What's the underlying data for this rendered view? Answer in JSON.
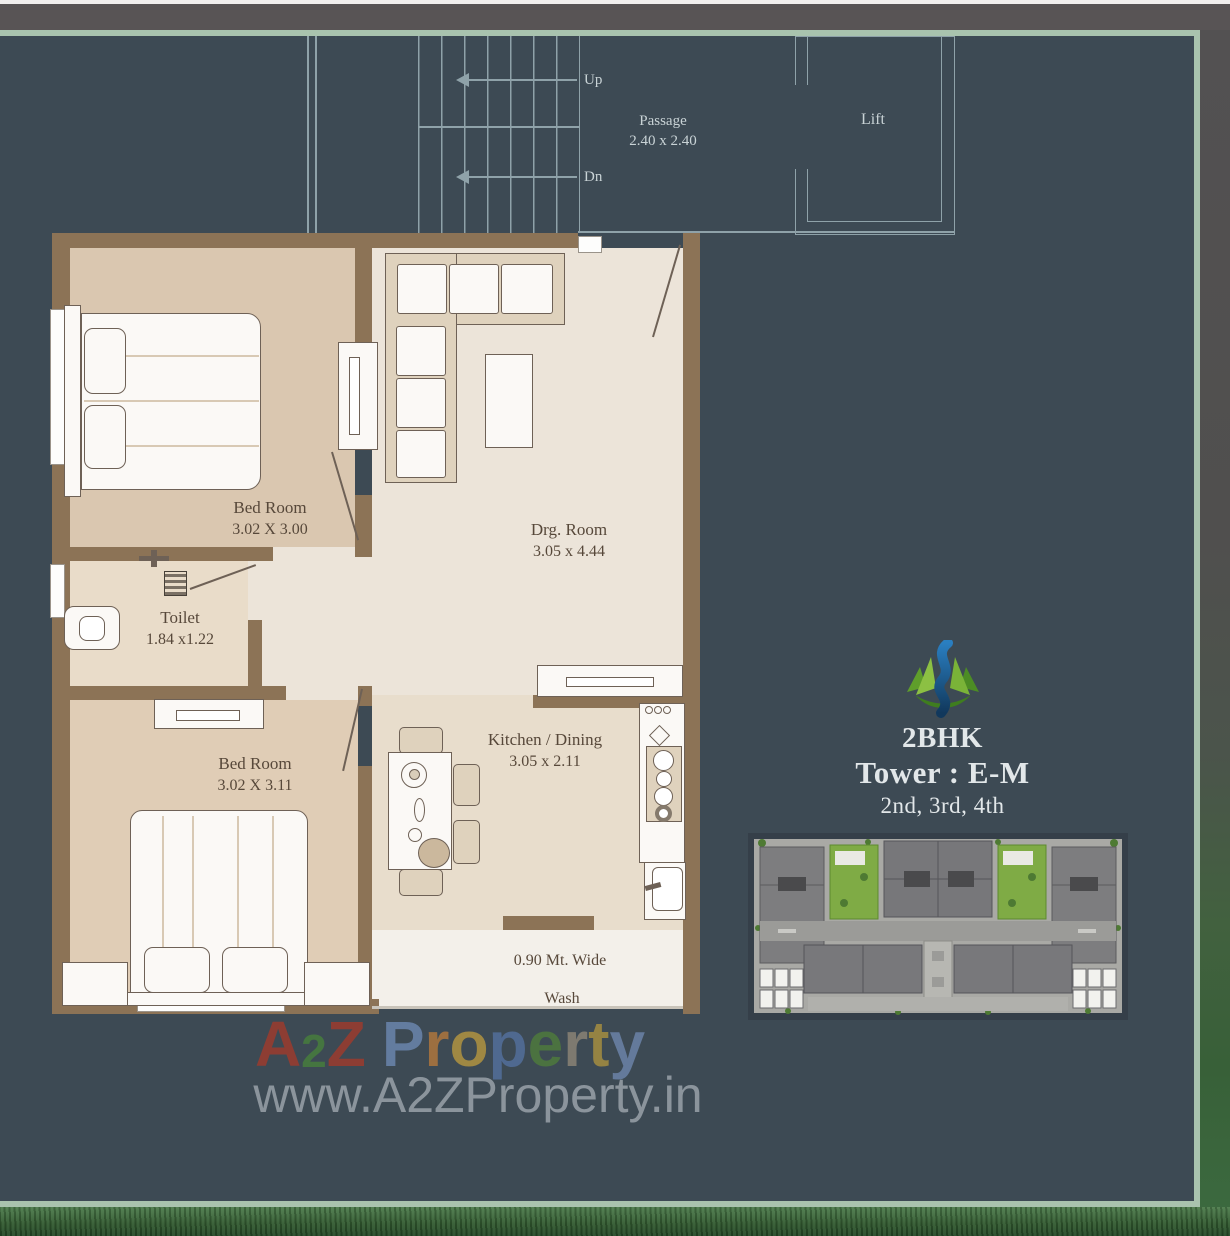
{
  "plan": {
    "stairwell": {
      "up": "Up",
      "dn": "Dn",
      "passage": "Passage",
      "passage_dim": "2.40 x 2.40",
      "lift": "Lift"
    },
    "rooms": {
      "bedroom1": {
        "name": "Bed Room",
        "dim": "3.02 X 3.00"
      },
      "toilet": {
        "name": "Toilet",
        "dim": "1.84 x1.22"
      },
      "drawing": {
        "name": "Drg. Room",
        "dim": "3.05 x 4.44"
      },
      "bedroom2": {
        "name": "Bed Room",
        "dim": "3.02 X 3.11"
      },
      "kitchen": {
        "name": "Kitchen / Dining",
        "dim": "3.05 x 2.11"
      },
      "wash": {
        "width_note": "0.90 Mt. Wide",
        "name": "Wash"
      }
    }
  },
  "unit_info": {
    "type": "2BHK",
    "tower": "Tower : E-M",
    "floors": "2nd, 3rd, 4th",
    "logo": "a2z-leaf-flame-logo"
  },
  "watermark": {
    "brand": "A2Z Property",
    "letters": [
      {
        "ch": "A",
        "color": "#a23a2b"
      },
      {
        "ch": "2",
        "color": "#47803c",
        "small": true
      },
      {
        "ch": "Z",
        "color": "#a23a2b"
      },
      {
        "ch": " ",
        "color": ""
      },
      {
        "ch": "P",
        "color": "#6d89b2"
      },
      {
        "ch": "r",
        "color": "#b5793c"
      },
      {
        "ch": "o",
        "color": "#b8983f"
      },
      {
        "ch": "p",
        "color": "#54719f"
      },
      {
        "ch": "e",
        "color": "#4f7c3c"
      },
      {
        "ch": "r",
        "color": "#8f8678"
      },
      {
        "ch": "t",
        "color": "#ab923f"
      },
      {
        "ch": "y",
        "color": "#6e87ad"
      }
    ],
    "url": "www.A2ZProperty.in"
  },
  "colors": {
    "panel": "#3d4a54",
    "panel_border": "#a9c3ae",
    "wall_brown": "#8c7356",
    "bedroom_floor": "#dac7b0",
    "living_floor": "#ece4d9",
    "kitchen_floor": "#e8ddcc",
    "wash_floor": "#f3f0ea",
    "stair_line": "#8fa2a9",
    "label_text": "#57483a",
    "stair_text": "#c9d3d6",
    "logo_blue": "#2a7fc1",
    "logo_green": "#7ab338"
  }
}
